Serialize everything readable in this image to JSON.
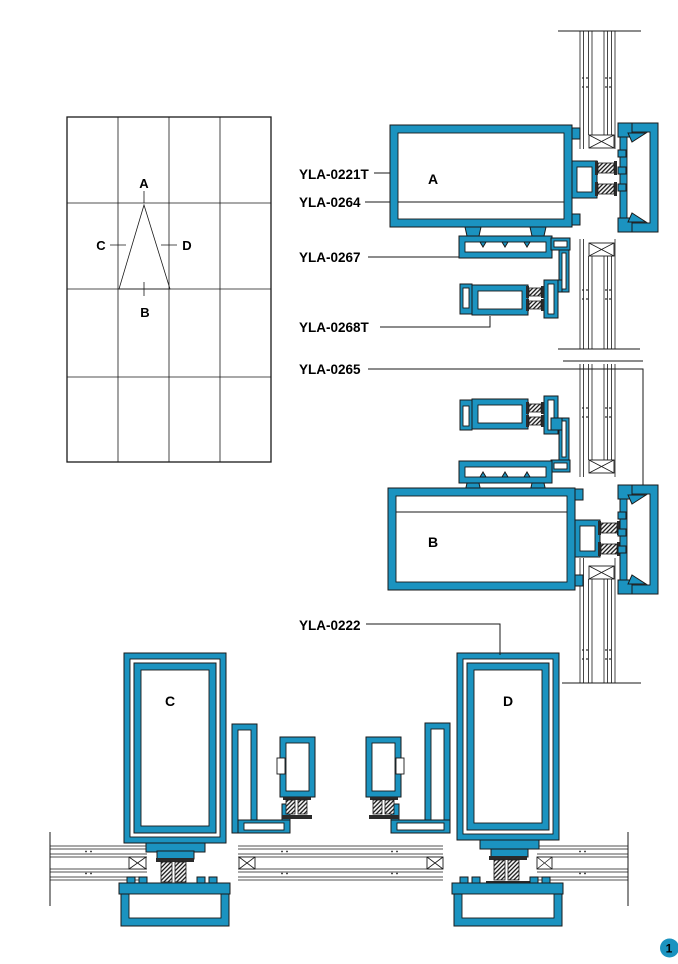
{
  "colors": {
    "profile_blue": "#1B93C0",
    "line_color": "#1a1a1a"
  },
  "overview": {
    "marker_top": "A",
    "marker_bottom": "B",
    "marker_left": "C",
    "marker_right": "D"
  },
  "part_labels": [
    {
      "text": "YLA-0221T"
    },
    {
      "text": "YLA-0264"
    },
    {
      "text": "YLA-0267"
    },
    {
      "text": "YLA-0268T"
    },
    {
      "text": "YLA-0265"
    },
    {
      "text": "YLA-0222"
    }
  ],
  "sections": {
    "a": "A",
    "b": "B",
    "c": "C",
    "d": "D"
  },
  "page_badge": "1"
}
